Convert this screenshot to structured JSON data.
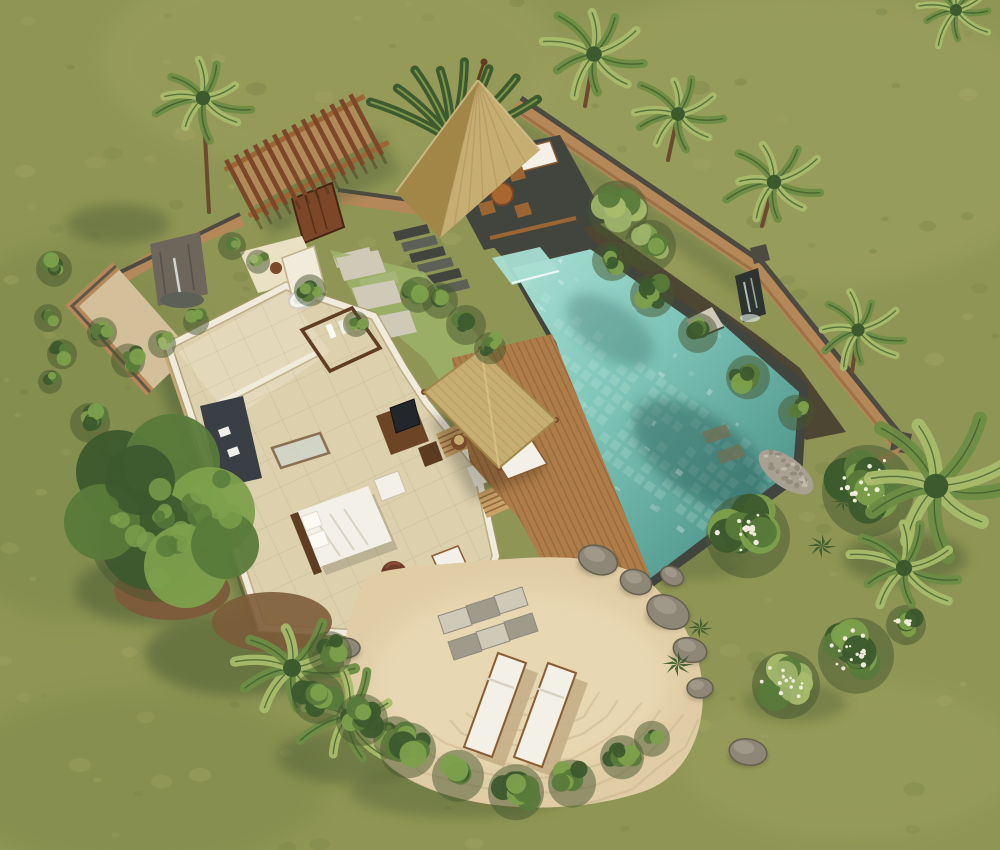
{
  "meta": {
    "title": "Aerial 3D rendering of a tropical pool villa",
    "image_type": "architectural-render",
    "view": "top-down aerial"
  },
  "palette": {
    "grass_base": "#8f9655",
    "grass_light": "#abac68",
    "grass_dark": "#6e7c43",
    "grass_shadow": "#45552e",
    "pool_water": "#7fc5b9",
    "pool_deep": "#4f968b",
    "pool_light": "#a9ded2",
    "pool_tile": "#d9f2ea",
    "stone_dark": "#42453e",
    "stone_mid": "#5d6057",
    "paver": "#cfc9b8",
    "paver_shadow": "#a09a8a",
    "wall_tan": "#b5885a",
    "wall_tan_light": "#c79e6f",
    "wall_cap": "#4d4a42",
    "wall_face_shadow": "#8a6138",
    "wood_red": "#7c4729",
    "wood_mid": "#9c6534",
    "deck_wood": "#ae7c48",
    "deck_gap": "#82592f",
    "thatch": "#c6ae72",
    "thatch_dark": "#a18648",
    "thatch_light": "#decb96",
    "floor": "#dcd0ad",
    "floor_light": "#eae0c4",
    "inner_wall": "#f1ebdb",
    "wall_outer_face": "#c9a877",
    "sand": "#e0cda5",
    "sand_shadow": "#c3ad85",
    "sand_light": "#efe1bf",
    "white_fabric": "#f3f0e7",
    "furn_dark": "#3a3e45",
    "wood_dark_furn": "#5f3d22",
    "rock": "#8e8677",
    "rock_light": "#a29a8a",
    "green_dark": "#3c5a2d",
    "green_mid": "#587a3a",
    "green_light": "#7da04c",
    "green_pale": "#9db36a",
    "palm_green": "#6d8c44",
    "palm_light": "#a9bc6a",
    "soil": "#4a4132",
    "earth": "#7c5c3a",
    "flower_white": "#eeebd8",
    "waterfall_dark": "#2e3330"
  },
  "scene": {
    "elements": {
      "lawn": {
        "label": "Grass lawn surrounding the villa"
      },
      "perimeter_wall": {
        "label": "Tan perimeter wall with dark stone coping"
      },
      "pool": {
        "label": "Turquoise tiled swimming pool"
      },
      "spa": {
        "label": "Raised spa terrace with waterfall edge"
      },
      "gazebo": {
        "label": "Thatched-roof dining gazebo"
      },
      "pergola": {
        "label": "Timber entrance pergola and gate"
      },
      "courtyard": {
        "label": "Walled garden bathroom courtyard with fountain"
      },
      "villa": {
        "label": "Open-roof villa interior with bedroom, bath and lounge"
      },
      "deck": {
        "label": "Timber pool deck with thatched sun canopy"
      },
      "sand_garden": {
        "label": "Sand garden with stepping stones and sun loungers"
      },
      "loungers": {
        "label": "Two white sun loungers"
      },
      "rocks": {
        "label": "Boulder border"
      },
      "vegetation": {
        "label": "Tropical trees, palms and shrubs"
      }
    }
  }
}
